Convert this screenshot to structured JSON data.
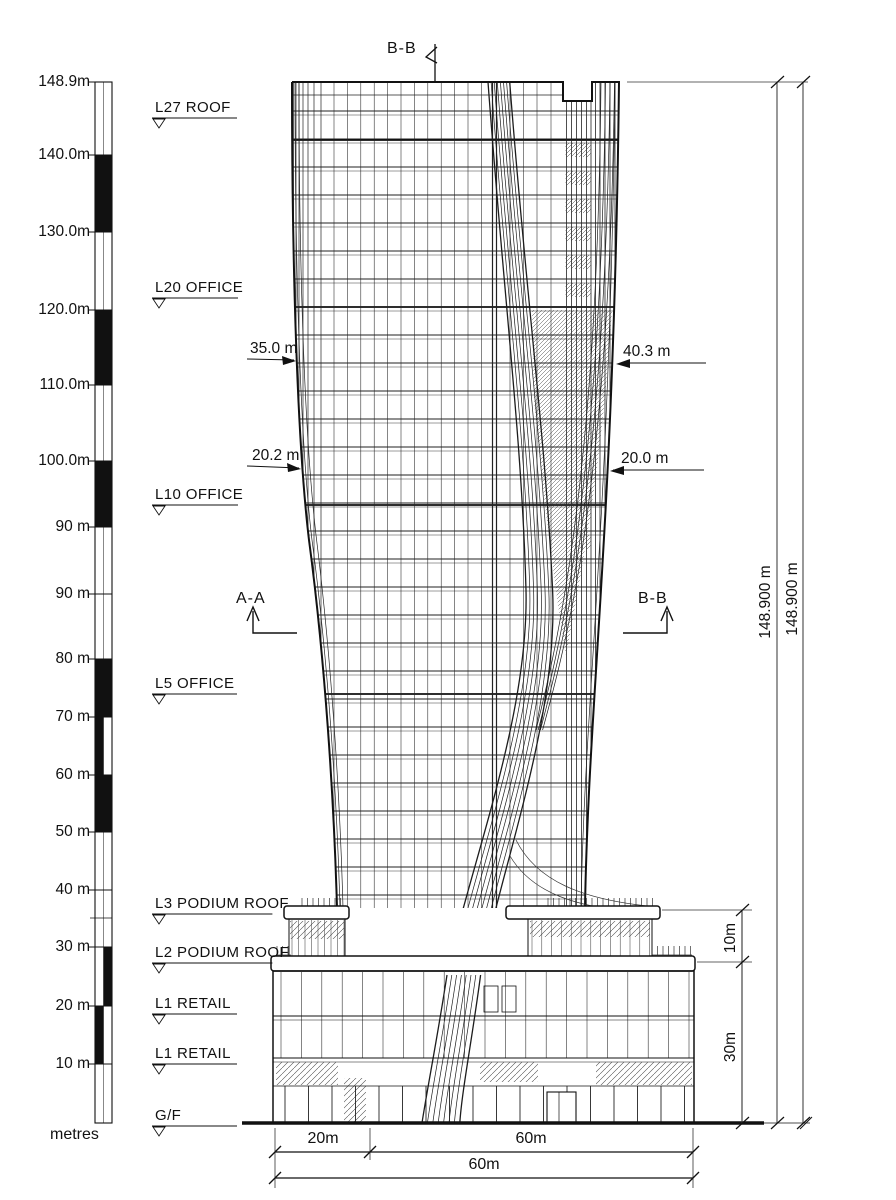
{
  "drawing": {
    "type": "architectural-elevation",
    "subject": "tower-elevation-section",
    "line_color": "#1c1c1c",
    "background": "#ffffff",
    "scale_bar": {
      "unit_label": "metres",
      "ticks": [
        {
          "label": "148.9m",
          "y": 82
        },
        {
          "label": "140.0m",
          "y": 155
        },
        {
          "label": "130.0m",
          "y": 232
        },
        {
          "label": "120.0m",
          "y": 310
        },
        {
          "label": "110.0m",
          "y": 385
        },
        {
          "label": "100.0m",
          "y": 461
        },
        {
          "label": "90 m",
          "y": 527
        },
        {
          "label": "90 m",
          "y": 594
        },
        {
          "label": "80 m",
          "y": 659
        },
        {
          "label": "70 m",
          "y": 717
        },
        {
          "label": "60 m",
          "y": 775
        },
        {
          "label": "50 m",
          "y": 832
        },
        {
          "label": "40 m",
          "y": 890
        },
        {
          "label": "30 m",
          "y": 947
        },
        {
          "label": "20 m",
          "y": 1006
        },
        {
          "label": "10 m",
          "y": 1064
        }
      ]
    },
    "levels": [
      {
        "label": "L27 ROOF",
        "y": 118
      },
      {
        "label": "L20 OFFICE",
        "y": 298
      },
      {
        "label": "L10 OFFICE",
        "y": 505
      },
      {
        "label": "L5 OFFICE",
        "y": 694
      },
      {
        "label": "L3 PODIUM ROOF",
        "y": 914
      },
      {
        "label": "L2 PODIUM ROOF",
        "y": 963
      },
      {
        "label": "L1 RETAIL",
        "y": 1014
      },
      {
        "label": "L1 RETAIL",
        "y": 1064
      },
      {
        "label": "G/F",
        "y": 1126
      }
    ],
    "width_dims": {
      "left_upper": "35.0 m",
      "right_upper": "40.3 m",
      "left_lower": "20.2 m",
      "right_lower": "20.0 m"
    },
    "section_markers": {
      "top": "B-B",
      "mid_left": "A-A",
      "mid_right": "B-B"
    },
    "height_dims": {
      "inner": "148.900 m",
      "outer": "148.900 m"
    },
    "podium_dims": {
      "upper": "10m",
      "lower": "30m"
    },
    "base_dims": {
      "left": "20m",
      "right": "60m",
      "total": "60m"
    }
  }
}
